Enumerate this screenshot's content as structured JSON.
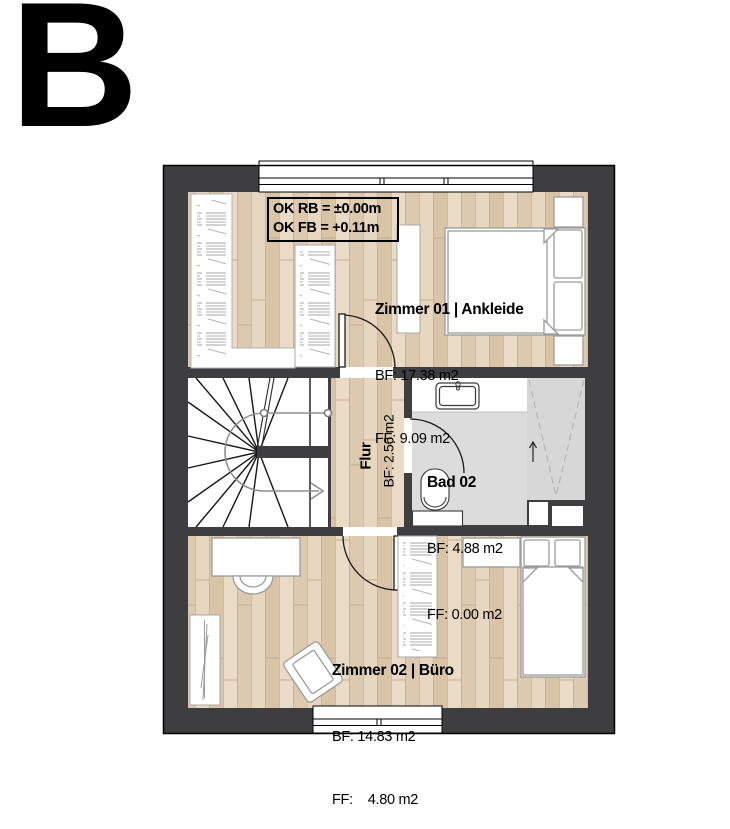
{
  "plan_letter": "B",
  "level_annotation": {
    "line1": "OK RB = ±0.00m",
    "line2": "OK FB = +0.11m"
  },
  "rooms": {
    "zimmer01": {
      "name": "Zimmer 01 | Ankleide",
      "bf": "BF: 17.38 m2",
      "ff": "FF: 9.09 m2"
    },
    "flur": {
      "name": "Flur",
      "bf": "BF: 2.56 m2"
    },
    "bad02": {
      "name": "Bad 02",
      "bf": "BF: 4.88 m2",
      "ff": "FF: 0.00 m2"
    },
    "zimmer02": {
      "name": "Zimmer 02 | Büro",
      "bf": "BF: 14.83 m2",
      "ff": "FF:    4.80 m2"
    }
  },
  "colors": {
    "wall": "#3e3d3f",
    "wood_base": "#e4d3bb",
    "tile": "#dcdcdc",
    "shower": "#d7d7d7",
    "furniture_border": "#9c9c9c",
    "outline": "#000000"
  }
}
